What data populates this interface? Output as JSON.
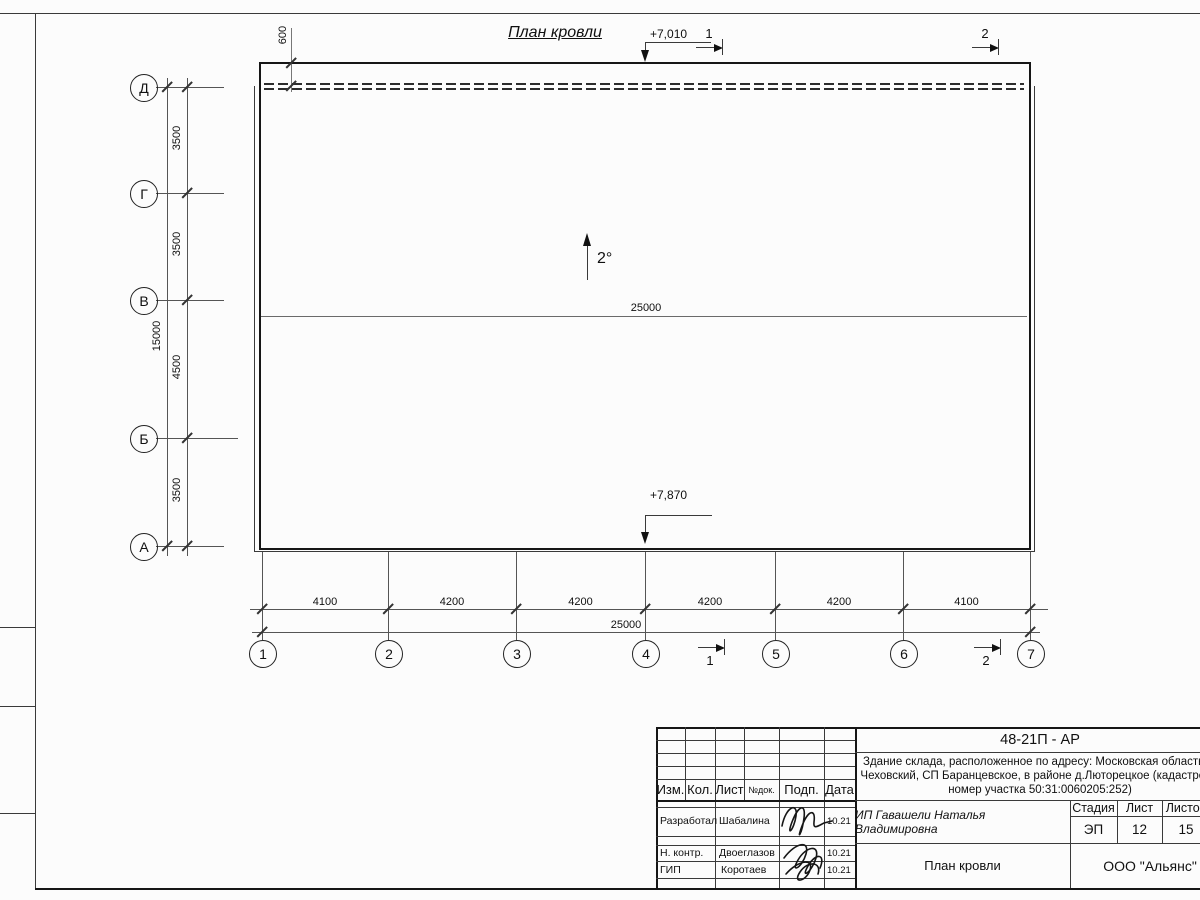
{
  "title": "План кровли",
  "roof": {
    "slope_label": "2°",
    "ridge_total": "25000",
    "parapet_offset": "600",
    "elev_top": "+7,010",
    "elev_bottom": "+7,870"
  },
  "sections": {
    "s1": "1",
    "s2": "2"
  },
  "grid": {
    "vertical_axes": [
      "1",
      "2",
      "3",
      "4",
      "5",
      "6",
      "7"
    ],
    "horizontal_axes": [
      "Д",
      "Г",
      "В",
      "Б",
      "А"
    ],
    "bottom_segments": [
      "4100",
      "4200",
      "4200",
      "4200",
      "4200",
      "4100"
    ],
    "bottom_total": "25000",
    "left_segments": [
      "3500",
      "3500",
      "4500",
      "3500"
    ],
    "left_total": "15000"
  },
  "title_block": {
    "code": "48-21П - АР",
    "description_line1": "Здание склада, расположенное по адресу: Московская область, р",
    "description_line2": "Чеховский, СП Баранцевское, в районе д.Люторецкое  (кадастровы",
    "description_line3": "номер участка 50:31:0060205:252)",
    "header_cols": [
      "Изм.",
      "Кол.",
      "Лист",
      "№док.",
      "Подп.",
      "Дата"
    ],
    "roles": [
      {
        "role": "Разработал",
        "name": "Шабалина",
        "date": "10.21"
      },
      {
        "role": "Н. контр.",
        "name": "Двоеглазов",
        "date": "10.21"
      },
      {
        "role": "ГИП",
        "name": "Коротаев",
        "date": "10.21"
      }
    ],
    "client": "ИП Гавашели Наталья Владимировна",
    "stage_header": [
      "Стадия",
      "Лист",
      "Листов"
    ],
    "stage_values": [
      "ЭП",
      "12",
      "15"
    ],
    "sheet_title": "План кровли",
    "company": "ООО \"Альянс\""
  }
}
